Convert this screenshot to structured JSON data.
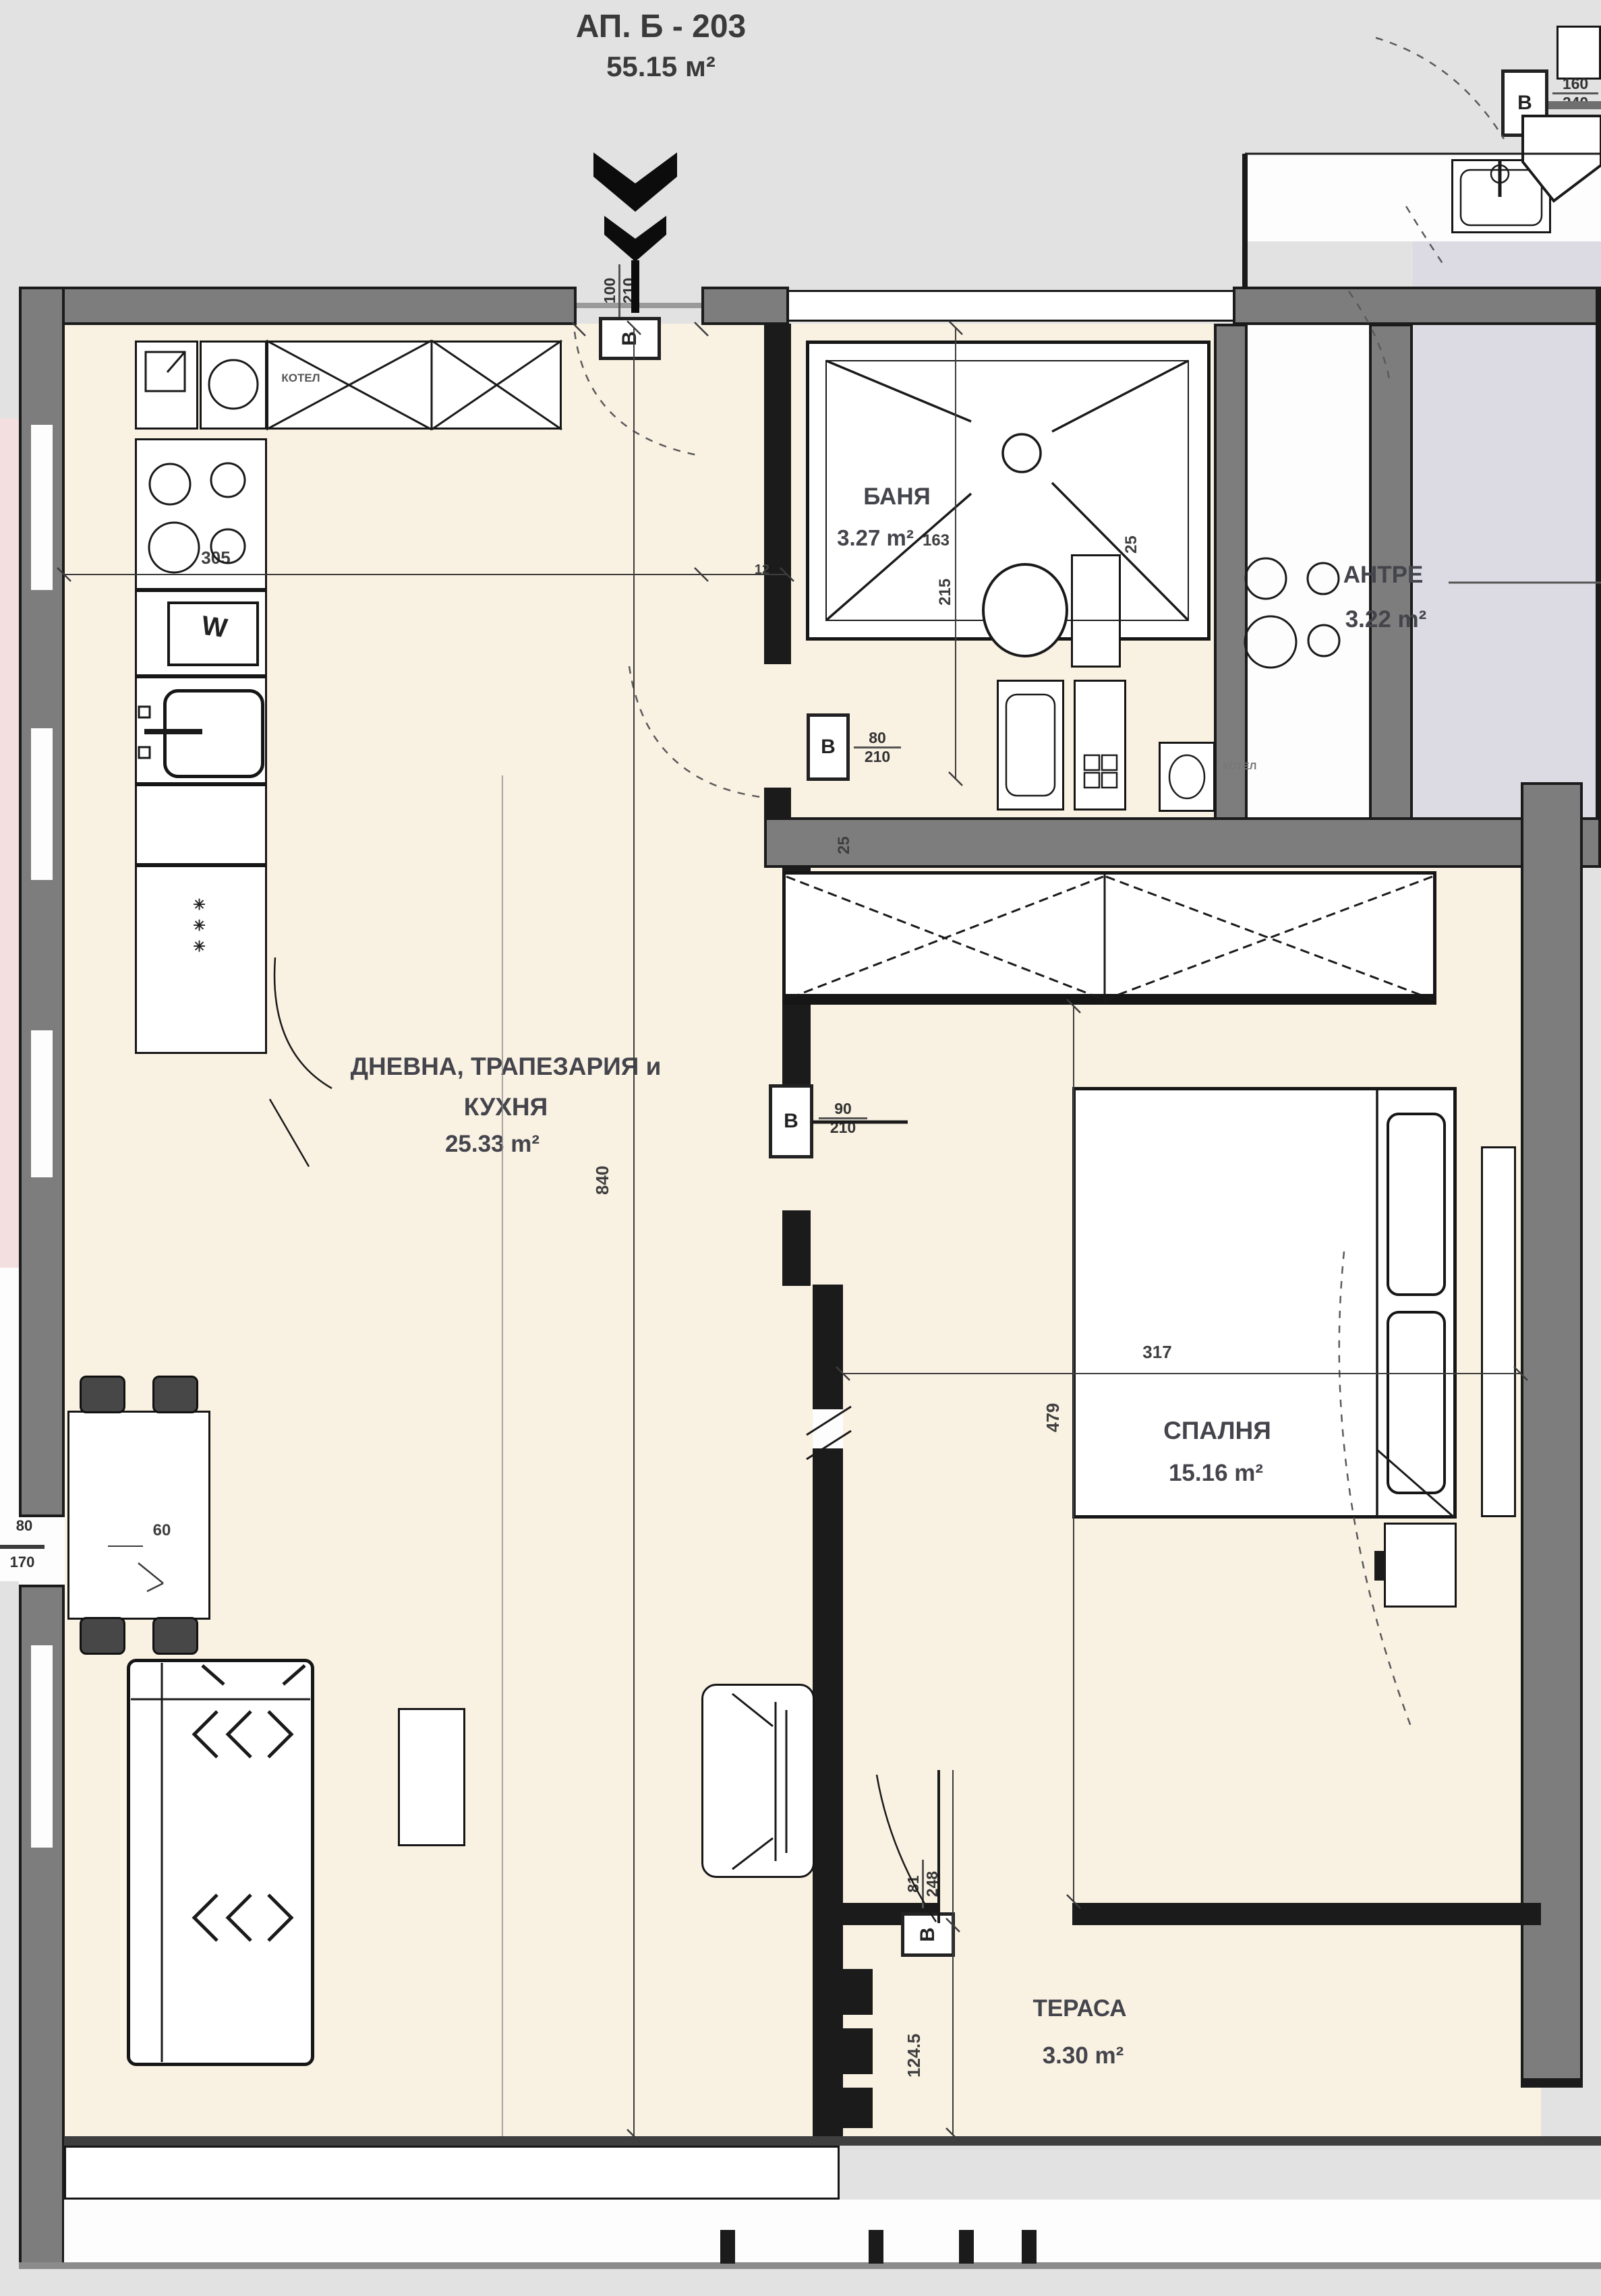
{
  "title": {
    "line1": "АП. Б - 203",
    "line2": "55.15 м²"
  },
  "rooms": {
    "living": {
      "name_line1": "ДНЕВНА, ТРАПЕЗАРИЯ и",
      "name_line2": "КУХНЯ",
      "area": "25.33 m²"
    },
    "bath": {
      "name": "БАНЯ",
      "area": "3.27 m²"
    },
    "antre": {
      "name": "АНТРЕ",
      "area": "3.22 m²"
    },
    "bedroom": {
      "name": "СПАЛНЯ",
      "area": "15.16 m²"
    },
    "terrace": {
      "name": "ТЕРАСА",
      "area": "3.30 m²"
    }
  },
  "doors": {
    "entrance": {
      "tag": "В",
      "width": "100",
      "height": "210"
    },
    "bath": {
      "tag": "В",
      "width": "80",
      "height": "210"
    },
    "bedroom": {
      "tag": "В",
      "width": "90",
      "height": "210"
    },
    "terrace": {
      "tag": "В",
      "width": "81",
      "height": "248"
    },
    "neighbor": {
      "tag": "В",
      "width": "160",
      "height": "240"
    }
  },
  "dimensions": {
    "kitchen_width": "305",
    "wall_small": "12",
    "bath_width": "163",
    "bath_depth": "215",
    "wall_25a": "25",
    "wall_25b": "25",
    "living_depth": "840",
    "bedroom_depth": "479",
    "bedroom_width": "317",
    "terrace_depth": "124.5",
    "niche": "60",
    "side_door_w": "80",
    "side_door_h": "170"
  },
  "appliances": {
    "boiler_kitchen": "КОТЕЛ",
    "boiler_bath": "КОТЕЛ",
    "washer_mark": "W",
    "fridge_marks": "✳ ✳ ✳"
  },
  "colors": {
    "floor": "#f9f1e2",
    "wall": "#7d7d7d",
    "adjacent": "#dcdbe3",
    "accent_pink": "#f3dfe0"
  }
}
